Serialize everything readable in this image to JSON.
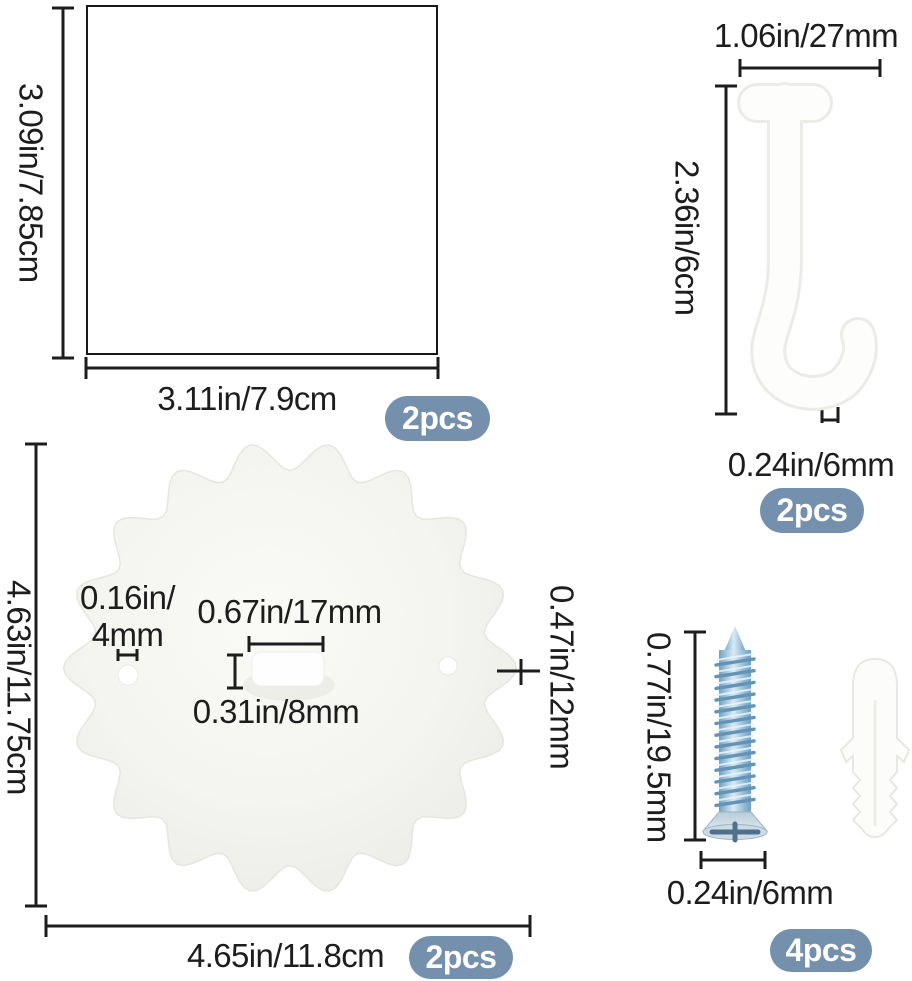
{
  "panels": {
    "square": {
      "height": "3.09in/7.85cm",
      "width": "3.11in/7.9cm",
      "count": "2pcs"
    },
    "hook": {
      "width": "1.06in/27mm",
      "height": "2.36in/6cm",
      "thickness": "0.24in/6mm",
      "count": "2pcs"
    },
    "disc": {
      "height": "4.63in/11.75cm",
      "width": "4.65in/11.8cm",
      "hole_line1": "0.16in/",
      "hole_line2": "4mm",
      "slot_width": "0.67in/17mm",
      "slot_height": "0.31in/8mm",
      "edge": "0.47in/12mm",
      "count": "2pcs"
    },
    "screw": {
      "length": "0.77in/19.5mm",
      "diameter": "0.24in/6mm",
      "count": "4pcs"
    }
  },
  "colors": {
    "badge_bg": "#7590ac",
    "line": "#1d1d1d",
    "screw_blue": "#7fb2d4",
    "disc_fill": "#f3f3f0",
    "plastic_white": "#fdfdfc"
  }
}
